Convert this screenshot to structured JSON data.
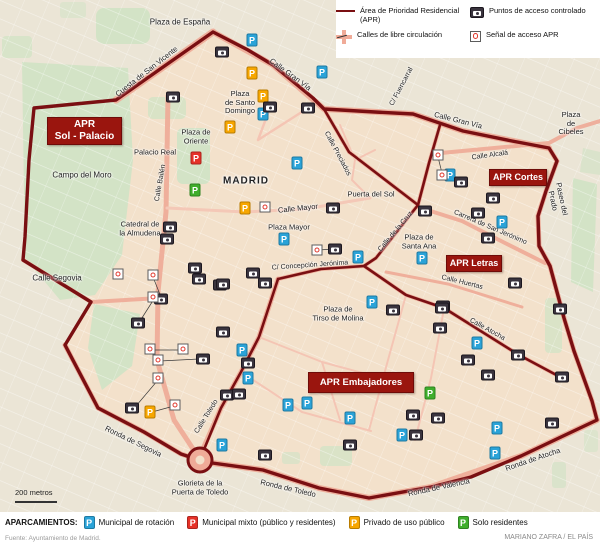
{
  "colors": {
    "apr_line": "#7a0f12",
    "free_street": "#f0ab98",
    "camera_bg": "#3a343e",
    "signal_red": "#e0392e",
    "parking_blue": "#2aa3d8",
    "parking_red": "#e63127",
    "parking_orange": "#f7a600",
    "parking_green": "#3fae2c",
    "apr_box_bg": "#9a150e",
    "map_inside": "#f3e1cb",
    "map_outside": "#ebe5d6",
    "park_green": "#d3e3c6"
  },
  "legend": {
    "apr_line_label": "Área de Prioridad Residencial (APR)",
    "free_street_label": "Calles de libre circulación",
    "camera_label": "Puntos de acceso controlado",
    "signal_label": "Señal de acceso APR"
  },
  "map": {
    "parking_letter": "P",
    "apr_zones": [
      {
        "text": "APR\nSol - Palacio",
        "x": 47,
        "y": 117,
        "w": 73,
        "h": 26,
        "fs": 10
      },
      {
        "text": "APR Cortes",
        "x": 489,
        "y": 169,
        "w": 56,
        "h": 15,
        "fs": 9
      },
      {
        "text": "APR Letras",
        "x": 446,
        "y": 255,
        "w": 54,
        "h": 15,
        "fs": 9
      },
      {
        "text": "APR Embajadores",
        "x": 308,
        "y": 372,
        "w": 104,
        "h": 19,
        "fs": 9.5
      }
    ],
    "labels": [
      {
        "text": "Plaza de España",
        "x": 180,
        "y": 22,
        "fs": 8
      },
      {
        "text": "Cuesta de San Vicente",
        "x": 147,
        "y": 72,
        "rot": -38,
        "fs": 7.5
      },
      {
        "text": "Plaza de\nOriente",
        "x": 196,
        "y": 137,
        "fs": 7.5
      },
      {
        "text": "Palacio Real",
        "x": 155,
        "y": 153,
        "fs": 7.5
      },
      {
        "text": "Campo del Moro",
        "x": 82,
        "y": 175,
        "fs": 8
      },
      {
        "text": "Catedral de\nla Almudena",
        "x": 140,
        "y": 229,
        "fs": 7.5
      },
      {
        "text": "Calle Bailén",
        "x": 161,
        "y": 183,
        "rot": -80,
        "fs": 7
      },
      {
        "text": "Calle Segovia",
        "x": 57,
        "y": 278,
        "fs": 8
      },
      {
        "text": "MADRID",
        "x": 246,
        "y": 181,
        "fs": 10,
        "bold": true
      },
      {
        "text": "Plaza\nde Santo\nDomingo",
        "x": 240,
        "y": 103,
        "fs": 7.5
      },
      {
        "text": "Calle Gran Vía",
        "x": 290,
        "y": 75,
        "rot": 36,
        "fs": 7.5
      },
      {
        "text": "C/ Fuencarral",
        "x": 402,
        "y": 87,
        "rot": -62,
        "fs": 7
      },
      {
        "text": "Calle Preciados",
        "x": 337,
        "y": 154,
        "rot": 62,
        "fs": 7
      },
      {
        "text": "Calle Gran Vía",
        "x": 458,
        "y": 121,
        "rot": 14,
        "fs": 7.5
      },
      {
        "text": "Plaza de\nCibeles",
        "x": 571,
        "y": 124,
        "fs": 7.5
      },
      {
        "text": "Calle Alcalá",
        "x": 490,
        "y": 156,
        "rot": -8,
        "fs": 7
      },
      {
        "text": "Paseo del Prado",
        "x": 557,
        "y": 200,
        "rot": 78,
        "fs": 7.5
      },
      {
        "text": "Puerta del Sol",
        "x": 371,
        "y": 195,
        "fs": 7.5
      },
      {
        "text": "Calle Mayor",
        "x": 298,
        "y": 209,
        "rot": -6,
        "fs": 7.5
      },
      {
        "text": "Plaza Mayor",
        "x": 289,
        "y": 228,
        "fs": 7.5
      },
      {
        "text": "Calle de la Cruz",
        "x": 396,
        "y": 232,
        "rot": -50,
        "fs": 7
      },
      {
        "text": "Carrera de San Jerónimo",
        "x": 490,
        "y": 228,
        "rot": 23,
        "fs": 7
      },
      {
        "text": "Plaza de\nSanta Ana",
        "x": 419,
        "y": 242,
        "fs": 7.5
      },
      {
        "text": "C/ Concepción Jerónima",
        "x": 310,
        "y": 266,
        "rot": -4,
        "fs": 7
      },
      {
        "text": "Calle Huertas",
        "x": 462,
        "y": 283,
        "rot": 14,
        "fs": 7
      },
      {
        "text": "Calle Atocha",
        "x": 487,
        "y": 330,
        "rot": 29,
        "fs": 7
      },
      {
        "text": "Plaza de\nTirso de Molina",
        "x": 338,
        "y": 314,
        "fs": 7.5
      },
      {
        "text": "Calle Toledo",
        "x": 207,
        "y": 417,
        "rot": -58,
        "fs": 7
      },
      {
        "text": "Ronda de Segovia",
        "x": 133,
        "y": 442,
        "rot": 26,
        "fs": 7.5
      },
      {
        "text": "Glorieta de la\nPuerta de Toledo",
        "x": 200,
        "y": 488,
        "fs": 7.5
      },
      {
        "text": "Ronda de Toledo",
        "x": 288,
        "y": 489,
        "rot": 13,
        "fs": 7.5
      },
      {
        "text": "Ronda de Valencia",
        "x": 439,
        "y": 488,
        "rot": -12,
        "fs": 7.5
      },
      {
        "text": "Ronda de Atocha",
        "x": 533,
        "y": 460,
        "rot": -19,
        "fs": 7.5
      }
    ],
    "parkings": [
      {
        "t": "blue",
        "x": 252,
        "y": 40
      },
      {
        "t": "blue",
        "x": 322,
        "y": 72
      },
      {
        "t": "blue",
        "x": 263,
        "y": 114
      },
      {
        "t": "blue",
        "x": 297,
        "y": 163
      },
      {
        "t": "blue",
        "x": 284,
        "y": 239
      },
      {
        "t": "blue",
        "x": 358,
        "y": 257
      },
      {
        "t": "blue",
        "x": 502,
        "y": 222
      },
      {
        "t": "blue",
        "x": 422,
        "y": 258
      },
      {
        "t": "blue",
        "x": 450,
        "y": 175
      },
      {
        "t": "blue",
        "x": 242,
        "y": 350
      },
      {
        "t": "blue",
        "x": 248,
        "y": 378
      },
      {
        "t": "blue",
        "x": 372,
        "y": 302
      },
      {
        "t": "blue",
        "x": 288,
        "y": 405
      },
      {
        "t": "blue",
        "x": 307,
        "y": 403
      },
      {
        "t": "blue",
        "x": 350,
        "y": 418
      },
      {
        "t": "blue",
        "x": 477,
        "y": 343
      },
      {
        "t": "blue",
        "x": 497,
        "y": 428
      },
      {
        "t": "blue",
        "x": 495,
        "y": 453
      },
      {
        "t": "blue",
        "x": 402,
        "y": 435
      },
      {
        "t": "blue",
        "x": 222,
        "y": 445
      },
      {
        "t": "orange",
        "x": 252,
        "y": 73
      },
      {
        "t": "orange",
        "x": 263,
        "y": 96
      },
      {
        "t": "orange",
        "x": 230,
        "y": 127
      },
      {
        "t": "orange",
        "x": 245,
        "y": 208
      },
      {
        "t": "orange",
        "x": 150,
        "y": 412
      },
      {
        "t": "red",
        "x": 196,
        "y": 158
      },
      {
        "t": "green",
        "x": 195,
        "y": 190
      },
      {
        "t": "green",
        "x": 430,
        "y": 393
      }
    ],
    "cameras": [
      [
        222,
        52
      ],
      [
        173,
        97
      ],
      [
        270,
        107
      ],
      [
        308,
        108
      ],
      [
        333,
        208
      ],
      [
        170,
        227
      ],
      [
        167,
        239
      ],
      [
        195,
        268
      ],
      [
        220,
        285
      ],
      [
        253,
        273
      ],
      [
        265,
        283
      ],
      [
        335,
        249
      ],
      [
        425,
        211
      ],
      [
        461,
        182
      ],
      [
        493,
        198
      ],
      [
        478,
        213
      ],
      [
        488,
        238
      ],
      [
        515,
        283
      ],
      [
        443,
        306
      ],
      [
        393,
        310
      ],
      [
        199,
        279
      ],
      [
        223,
        284
      ],
      [
        138,
        323
      ],
      [
        161,
        299
      ],
      [
        203,
        359
      ],
      [
        223,
        332
      ],
      [
        248,
        363
      ],
      [
        132,
        408
      ],
      [
        227,
        395
      ],
      [
        239,
        394
      ],
      [
        265,
        455
      ],
      [
        350,
        445
      ],
      [
        416,
        435
      ],
      [
        442,
        308
      ],
      [
        440,
        328
      ],
      [
        468,
        360
      ],
      [
        488,
        375
      ],
      [
        518,
        355
      ],
      [
        562,
        377
      ],
      [
        560,
        309
      ],
      [
        413,
        415
      ],
      [
        438,
        418
      ],
      [
        552,
        423
      ]
    ],
    "signals": [
      [
        438,
        155
      ],
      [
        442,
        175
      ],
      [
        265,
        207
      ],
      [
        317,
        250
      ],
      [
        118,
        274
      ],
      [
        153,
        275
      ],
      [
        153,
        297
      ],
      [
        150,
        349
      ],
      [
        183,
        349
      ],
      [
        158,
        360
      ],
      [
        158,
        378
      ],
      [
        175,
        405
      ]
    ]
  },
  "scale": {
    "label": "200 metros"
  },
  "footer": {
    "title": "APARCAMIENTOS:",
    "items": [
      {
        "type": "blue",
        "label": "Municipal de rotación"
      },
      {
        "type": "red",
        "label": "Municipal mixto (público y residentes)"
      },
      {
        "type": "orange",
        "label": "Privado de uso público"
      },
      {
        "type": "green",
        "label": "Solo residentes"
      }
    ],
    "source": "Fuente: Ayuntamiento de Madrid.",
    "credit": "MARIANO ZAFRA / EL PAÍS"
  }
}
